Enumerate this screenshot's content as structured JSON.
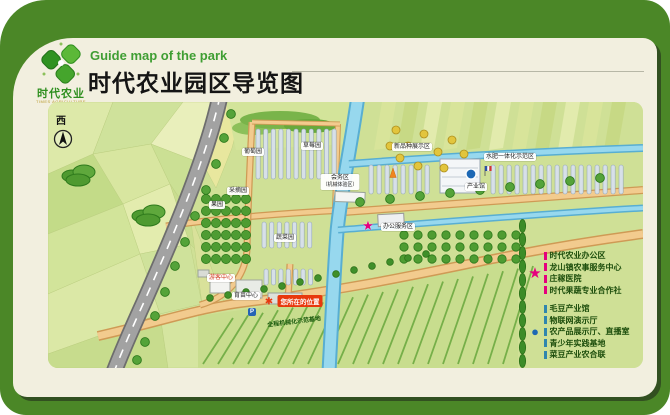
{
  "header": {
    "eng_title": "Guide map of the park",
    "cn_title": "时代农业园区导览图",
    "logo": {
      "name": "时代农业",
      "sub": "TIMES AGRICULTURE"
    }
  },
  "compass": {
    "west": "西"
  },
  "icons": {
    "star": "★",
    "dot": "●",
    "pin": "✱"
  },
  "map_labels": {
    "grape": "葡萄园",
    "strawberry": "草莓园",
    "new_variety": "新品种展示区",
    "water_fertilizer": "水肥一体化示范区",
    "picking": "采摘园",
    "orchard": "果园",
    "vegetable": "蔬菜园",
    "meeting_line1": "会务区",
    "meeting_line2": "（机械体验区）",
    "office": "办公服务区",
    "industry_hall": "产业馆",
    "seedling_center": "育苗中心",
    "visitor_center": "游客中心",
    "mech_base": "全程机械化示范基地",
    "you_are_here": "您所在的位置",
    "parking": "P"
  },
  "legend": {
    "star_items": [
      "时代农业办公区",
      "龙山镇农事服务中心",
      "庄稼医院",
      "时代果蔬专业合作社"
    ],
    "circle_items": [
      "毛豆产业馆",
      "物联网演示厅",
      "农产品展示厅、直播室",
      "青少年实践基地",
      "菜豆产业农合联"
    ]
  },
  "colors": {
    "frame_green": "#4b8727",
    "panel_cream": "#f2efdf",
    "map_green": "#cfe096",
    "star_pink": "#e5007d",
    "marker_blue": "#1d68b4",
    "badge_red": "#e8380d",
    "title_green": "#3f9e33"
  }
}
